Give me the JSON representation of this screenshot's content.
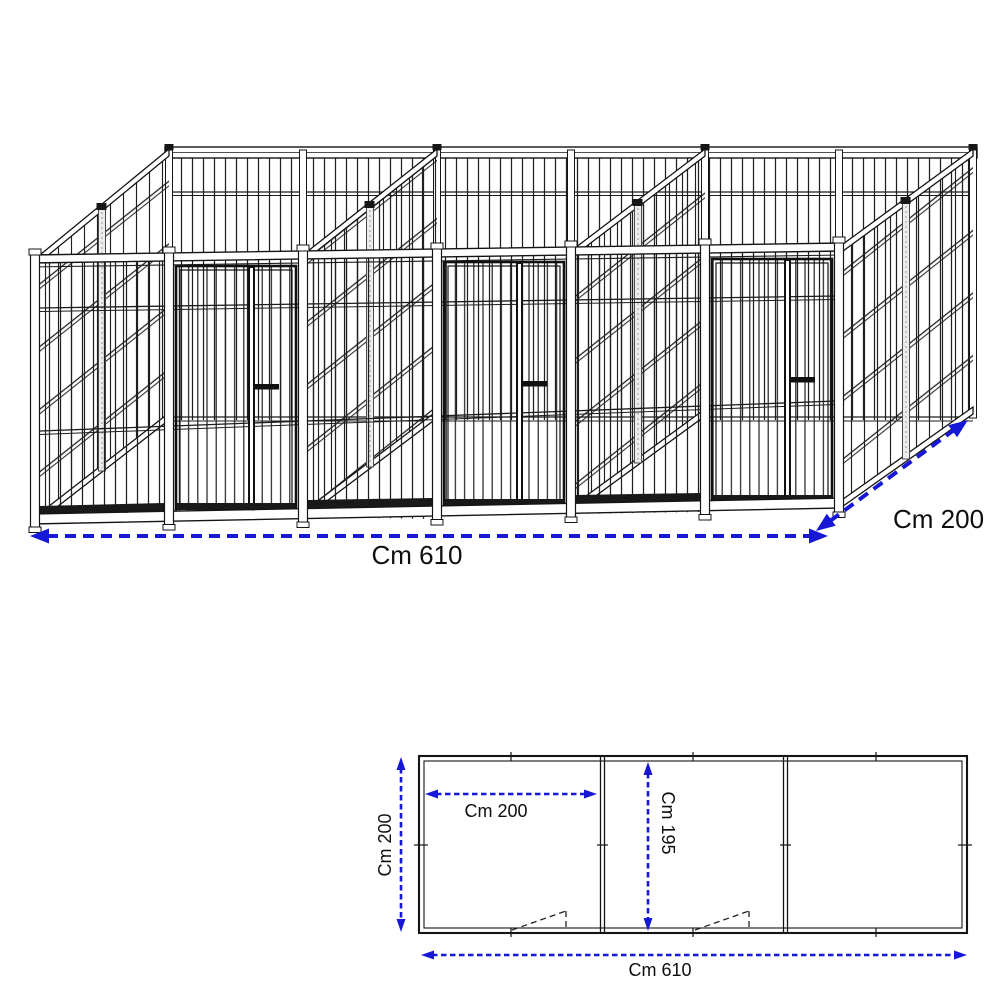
{
  "drawing": {
    "type": "kennel-technical-drawing",
    "iso_view": {
      "total_width_label": "Cm 610",
      "depth_label": "Cm 200"
    },
    "plan_view": {
      "side_depth_label": "Cm 200",
      "bay_width_label": "Cm 200",
      "bay_inner_depth_label": "Cm 195",
      "total_width_label": "Cm 610"
    },
    "colors": {
      "dimension_blue": "#1717d6",
      "line_black": "#141414"
    }
  }
}
